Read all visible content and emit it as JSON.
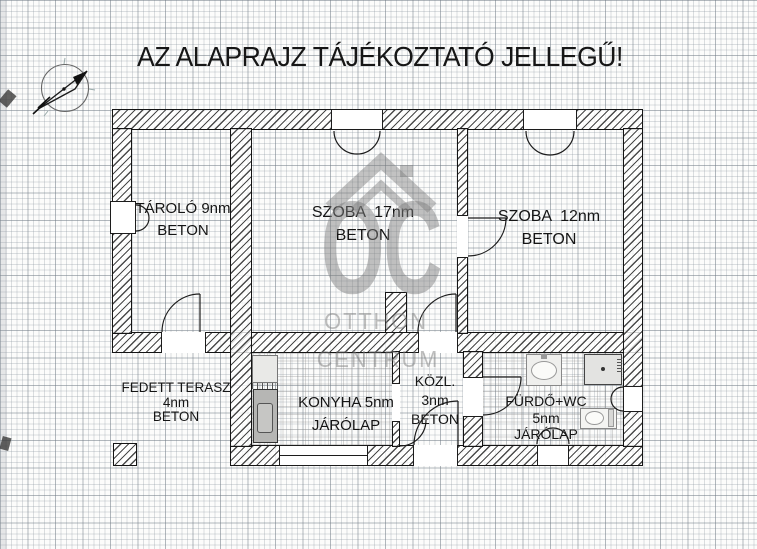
{
  "title": "AZ ALAPRAJZ TÁJÉKOZTATÓ JELLEGŰ!",
  "watermark": {
    "oc": "OC",
    "line2": "OTTHON",
    "line3": "CENTRUM"
  },
  "rooms": {
    "tarolo": {
      "line1": "TÁROLÓ 9nm",
      "line2": "BETON"
    },
    "szoba17": {
      "line1": "SZOBA  17nm",
      "line2": "BETON"
    },
    "szoba12": {
      "line1": "SZOBA  12nm",
      "line2": "BETON"
    },
    "terasz": {
      "line1": "FEDETT TERASZ",
      "line2": "4nm",
      "line3": "BETON"
    },
    "konyha": {
      "line1": "KONYHA 5nm",
      "line2": "JÁRÓLAP"
    },
    "kozl": {
      "line1": "KÖZL.",
      "line2": "3nm",
      "line3": "BETON"
    },
    "furdo": {
      "line1": "FÜRDŐ+WC",
      "line2": "5nm",
      "line3": "JÁRÓLAP"
    }
  },
  "colors": {
    "wall_outline": "#141414",
    "hatch_line": "#4a4a4a",
    "grid_minor": "#c6ccd2",
    "grid_major": "#9aa2aa",
    "watermark_gray": "#828282",
    "fixture_gray": "#b6b6b4"
  }
}
